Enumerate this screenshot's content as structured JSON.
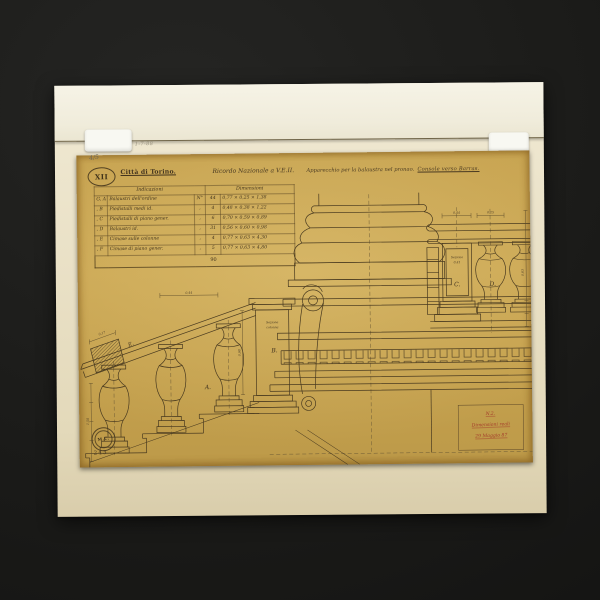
{
  "palette": {
    "background": "#1a1a18",
    "mat": "#e9e0c5",
    "sheet": "#c8a450",
    "ink": "#4a3a1e",
    "red_ink": "#a33a2a"
  },
  "annotations": {
    "pencil_fraction": "4/5",
    "mat_pencil_note": "1-7-88"
  },
  "header": {
    "stamp": "XII",
    "city": "Città di Torino.",
    "subject": "Ricordo Nazionale a V.E.II.",
    "description": "Apparecchio per la balaustra nel pronao.",
    "description2": "Console verso Barras."
  },
  "table": {
    "col_indicazioni": "Indicazioni",
    "col_dimensioni": "Dimensioni",
    "rows": [
      {
        "letter": "G, A",
        "desc": "Balaustri dell'ordine",
        "ncol": "N°",
        "qty": "44",
        "dims": "0,77 × 0,25 × 1,38"
      },
      {
        "letter": ", B",
        "desc": "Piedistalli medi id.",
        "ncol": ",",
        "qty": "4",
        "dims": "0,48 × 0,38 × 1,22"
      },
      {
        "letter": ", C",
        "desc": "Piedistalli di piano gener.",
        "ncol": ",",
        "qty": "6",
        "dims": "0,70 × 0,59 × 0,89"
      },
      {
        "letter": ", D",
        "desc": "Balaustri id.",
        "ncol": ",",
        "qty": "31",
        "dims": "0,56 × 0,60 × 0,98"
      },
      {
        "letter": ", E",
        "desc": "Cimase sulle colonne",
        "ncol": ",",
        "qty": "4",
        "dims": "0,77 × 0,63 × 4,30"
      },
      {
        "letter": ", F",
        "desc": "Cimase di piano gener.",
        "ncol": ",",
        "qty": "5",
        "dims": "0,77 × 0,63 × 4,80"
      }
    ],
    "total": "90"
  },
  "drawing": {
    "labels": {
      "a": "A.",
      "b": "B.",
      "c": "C.",
      "d": "D.",
      "e": "E."
    },
    "pedestal_b_text1": "Sezione",
    "pedestal_b_text2": "colonna",
    "panel_c_text1": "Sezione",
    "panel_c_text2": "0,41",
    "dims": {
      "stair_top": "0,44",
      "rail_section": "0,17",
      "left_chain": "1,58",
      "pedestal_b": "0,98",
      "ped_c_width": "0,44",
      "bal_d_width": "0,25",
      "right_chain": "0,63"
    }
  },
  "notes": {
    "red_line1": "N.2.",
    "red_line2": "Dimensioni reali",
    "red_line3": "29 Maggio 87"
  },
  "stamps": {
    "bottom_text": "M.C.",
    "bottom_number": "243"
  }
}
